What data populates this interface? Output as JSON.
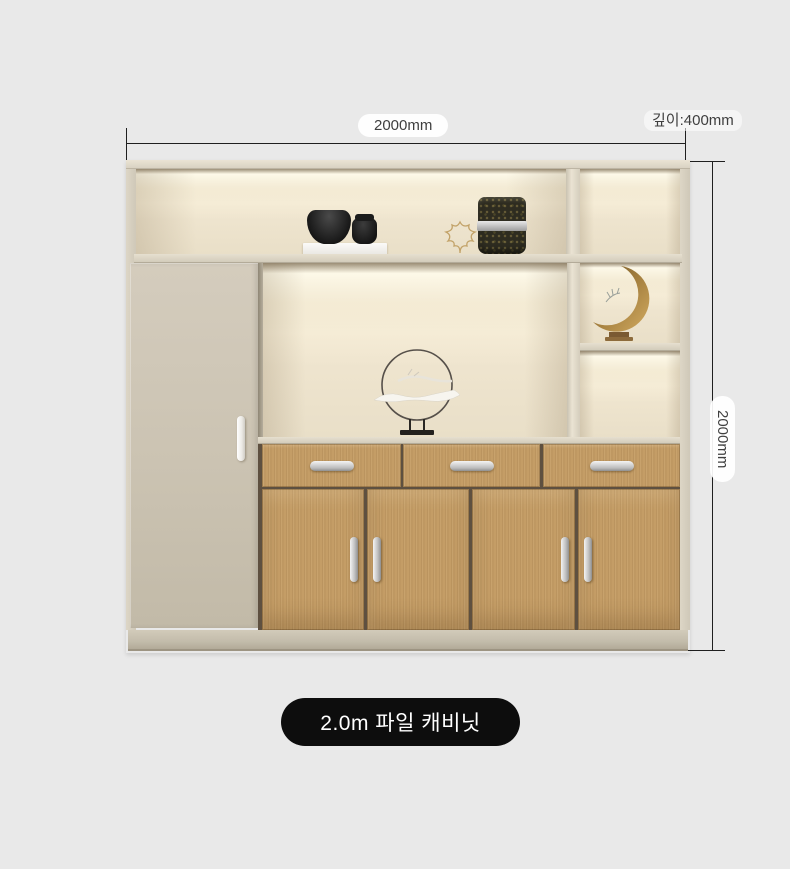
{
  "page": {
    "background": "#e9e9e9"
  },
  "annotations": {
    "width_label": "2000mm",
    "depth_label": "깊이:400mm",
    "height_label": "2000mm"
  },
  "product": {
    "label": "2.0m 파일 캐비닛"
  },
  "colors": {
    "page_bg": "#e9e9e9",
    "label_pill_bg": "#0d0d0d",
    "label_pill_text": "#ffffff",
    "dimension_line": "#1f1f1f",
    "dimension_text": "#3f3f3f",
    "frame": "#d8d1c1",
    "left_door": "#cdc5b4",
    "wood": "#c49d66",
    "niche_light": "#f8f0dc",
    "handle": "#d6d6d6",
    "moon_ornament": "#a5803f"
  },
  "decor": {
    "top_shelf": [
      "black-bowl",
      "black-jar",
      "gold-leaf-outline",
      "textured-canister"
    ],
    "center_niche": "ring-branch-sculpture",
    "right_column": "crescent-moon-ornament"
  }
}
